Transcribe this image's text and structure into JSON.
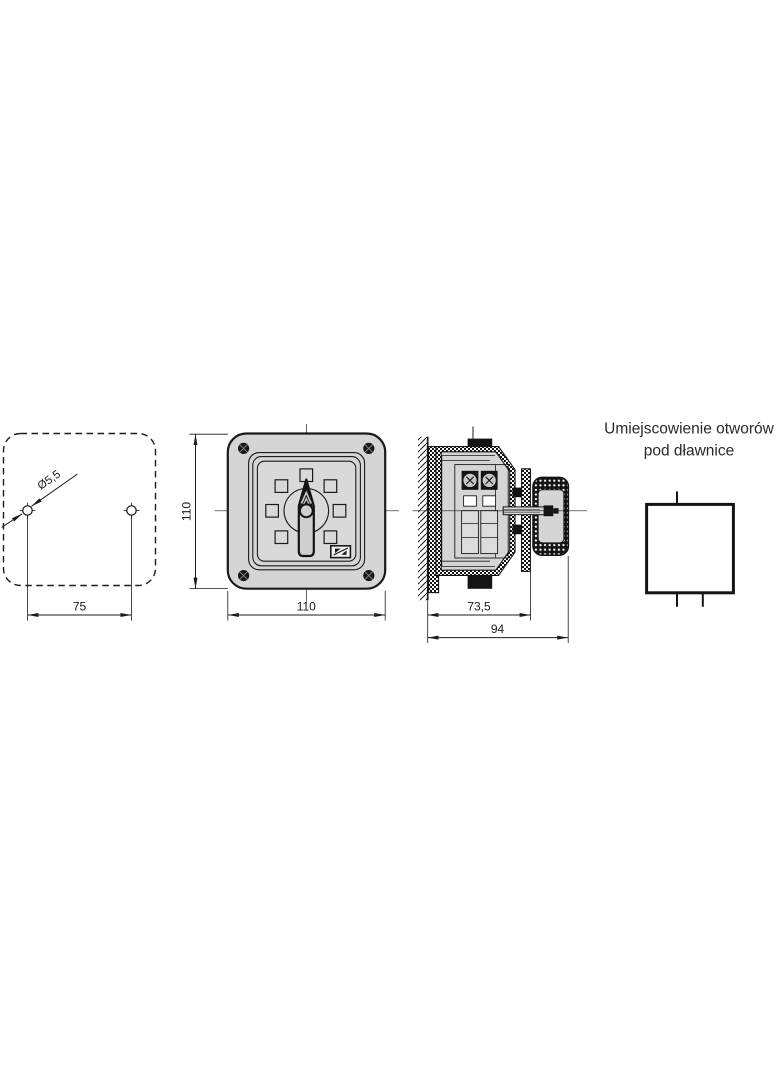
{
  "drawing": {
    "background": "#ffffff",
    "line_color": "#1c1a1a",
    "fill_gray": "#d5d5d5",
    "views": {
      "mounting": {
        "hole_diameter": "Ø5,5",
        "hole_spacing": "75"
      },
      "front": {
        "height": "110",
        "width": "110"
      },
      "section": {
        "mounting_depth": "73,5",
        "total_depth": "94"
      },
      "glands": {
        "title_line1": "Umiejscowienie otworów",
        "title_line2": "pod dławnice"
      }
    }
  }
}
